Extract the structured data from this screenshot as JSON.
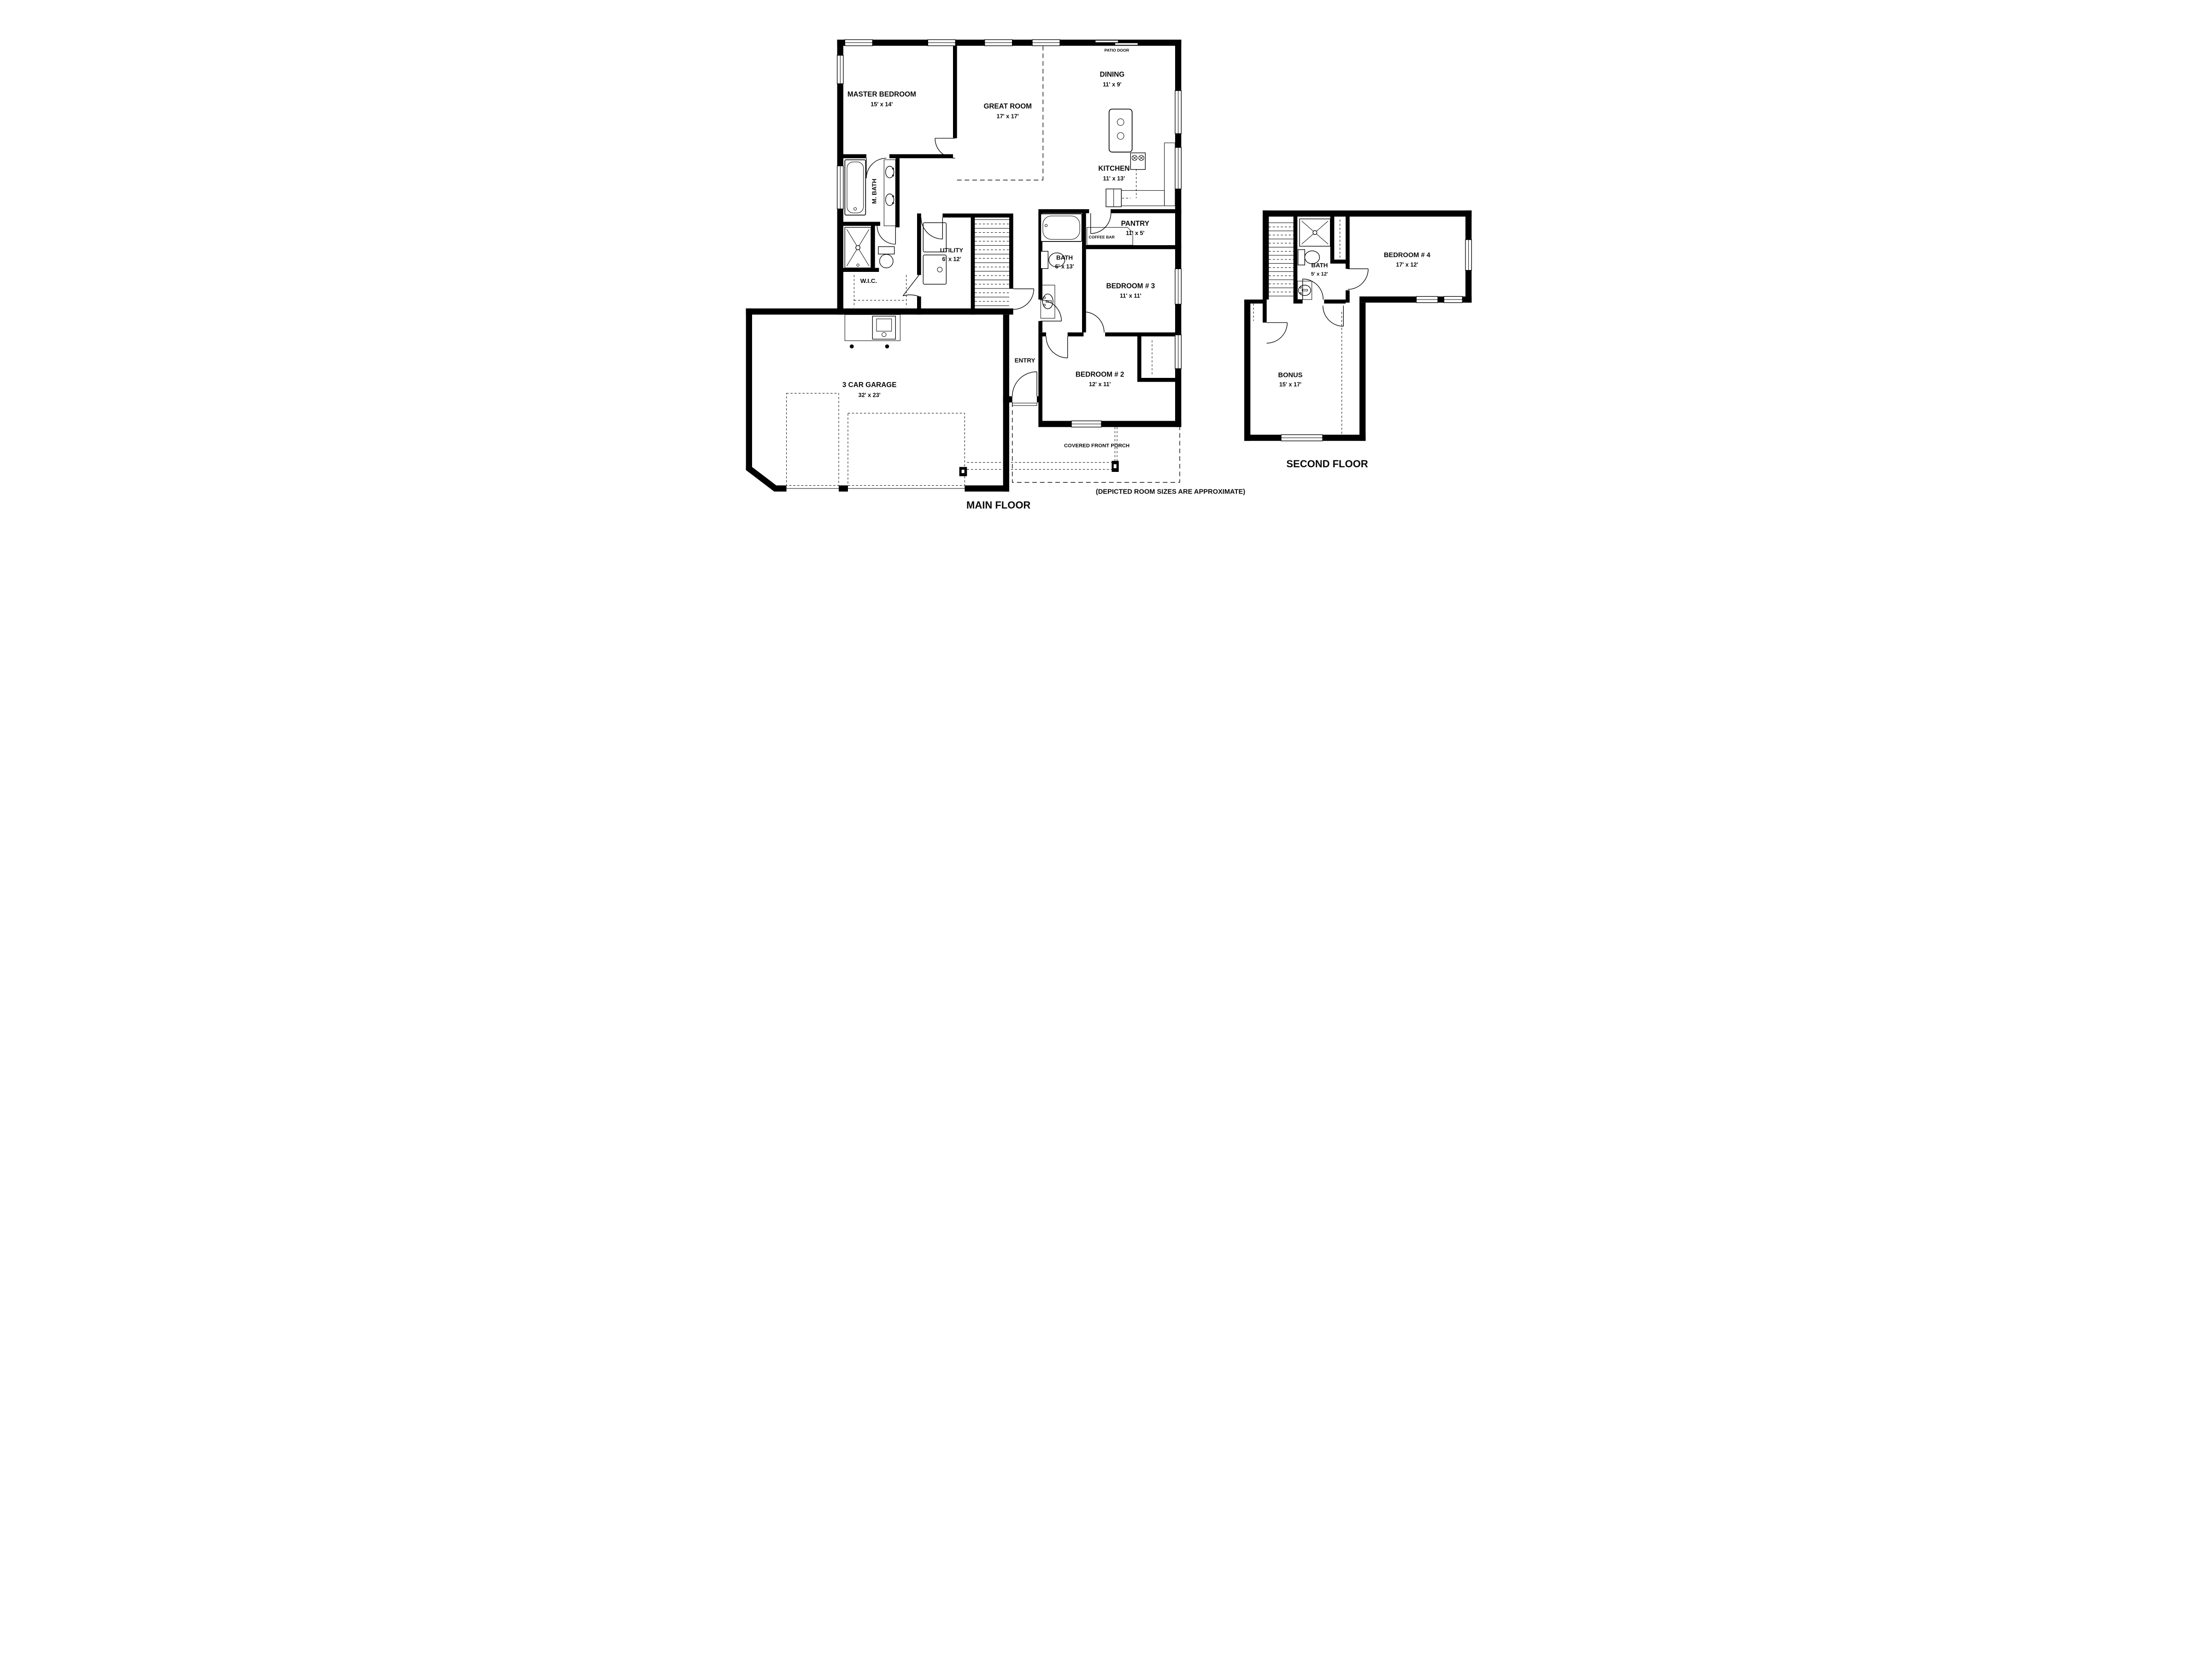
{
  "document_type": "residential floor plan",
  "colors": {
    "wall": "#000000",
    "background": "#ffffff",
    "text": "#0a0a0a"
  },
  "main": {
    "title": "MAIN FLOOR",
    "rooms": {
      "master": {
        "name": "MASTER BEDROOM",
        "size": "15' x 14'"
      },
      "great": {
        "name": "GREAT ROOM",
        "size": "17' x 17'"
      },
      "dining": {
        "name": "DINING",
        "size": "11' x 9'"
      },
      "kitchen": {
        "name": "KITCHEN",
        "size": "11' x 13'"
      },
      "pantry": {
        "name": "PANTRY",
        "size": "11' x 5'"
      },
      "mbath": {
        "name": "M. BATH"
      },
      "bath": {
        "name": "BATH",
        "size": "6' x 13'"
      },
      "utility": {
        "name": "UTILITY",
        "size": "6' x 12'"
      },
      "wic": {
        "name": "W.I.C."
      },
      "bed3": {
        "name": "BEDROOM # 3",
        "size": "11' x 11'"
      },
      "bed2": {
        "name": "BEDROOM # 2",
        "size": "12' x 11'"
      },
      "entry": {
        "name": "ENTRY"
      },
      "garage": {
        "name": "3 CAR GARAGE",
        "size": "32' x 23'"
      },
      "porch": {
        "name": "COVERED FRONT PORCH"
      }
    },
    "annotations": {
      "patio_door": "PATIO DOOR",
      "coffee_bar": "COFFEE BAR"
    }
  },
  "second": {
    "title": "SECOND FLOOR",
    "rooms": {
      "bath": {
        "name": "BATH",
        "size": "5' x 12'"
      },
      "bed4": {
        "name": "BEDROOM # 4",
        "size": "17' x 12'"
      },
      "bonus": {
        "name": "BONUS",
        "size": "15' x 17'"
      }
    }
  },
  "footnote": "(DEPICTED ROOM SIZES ARE APPROXIMATE)"
}
